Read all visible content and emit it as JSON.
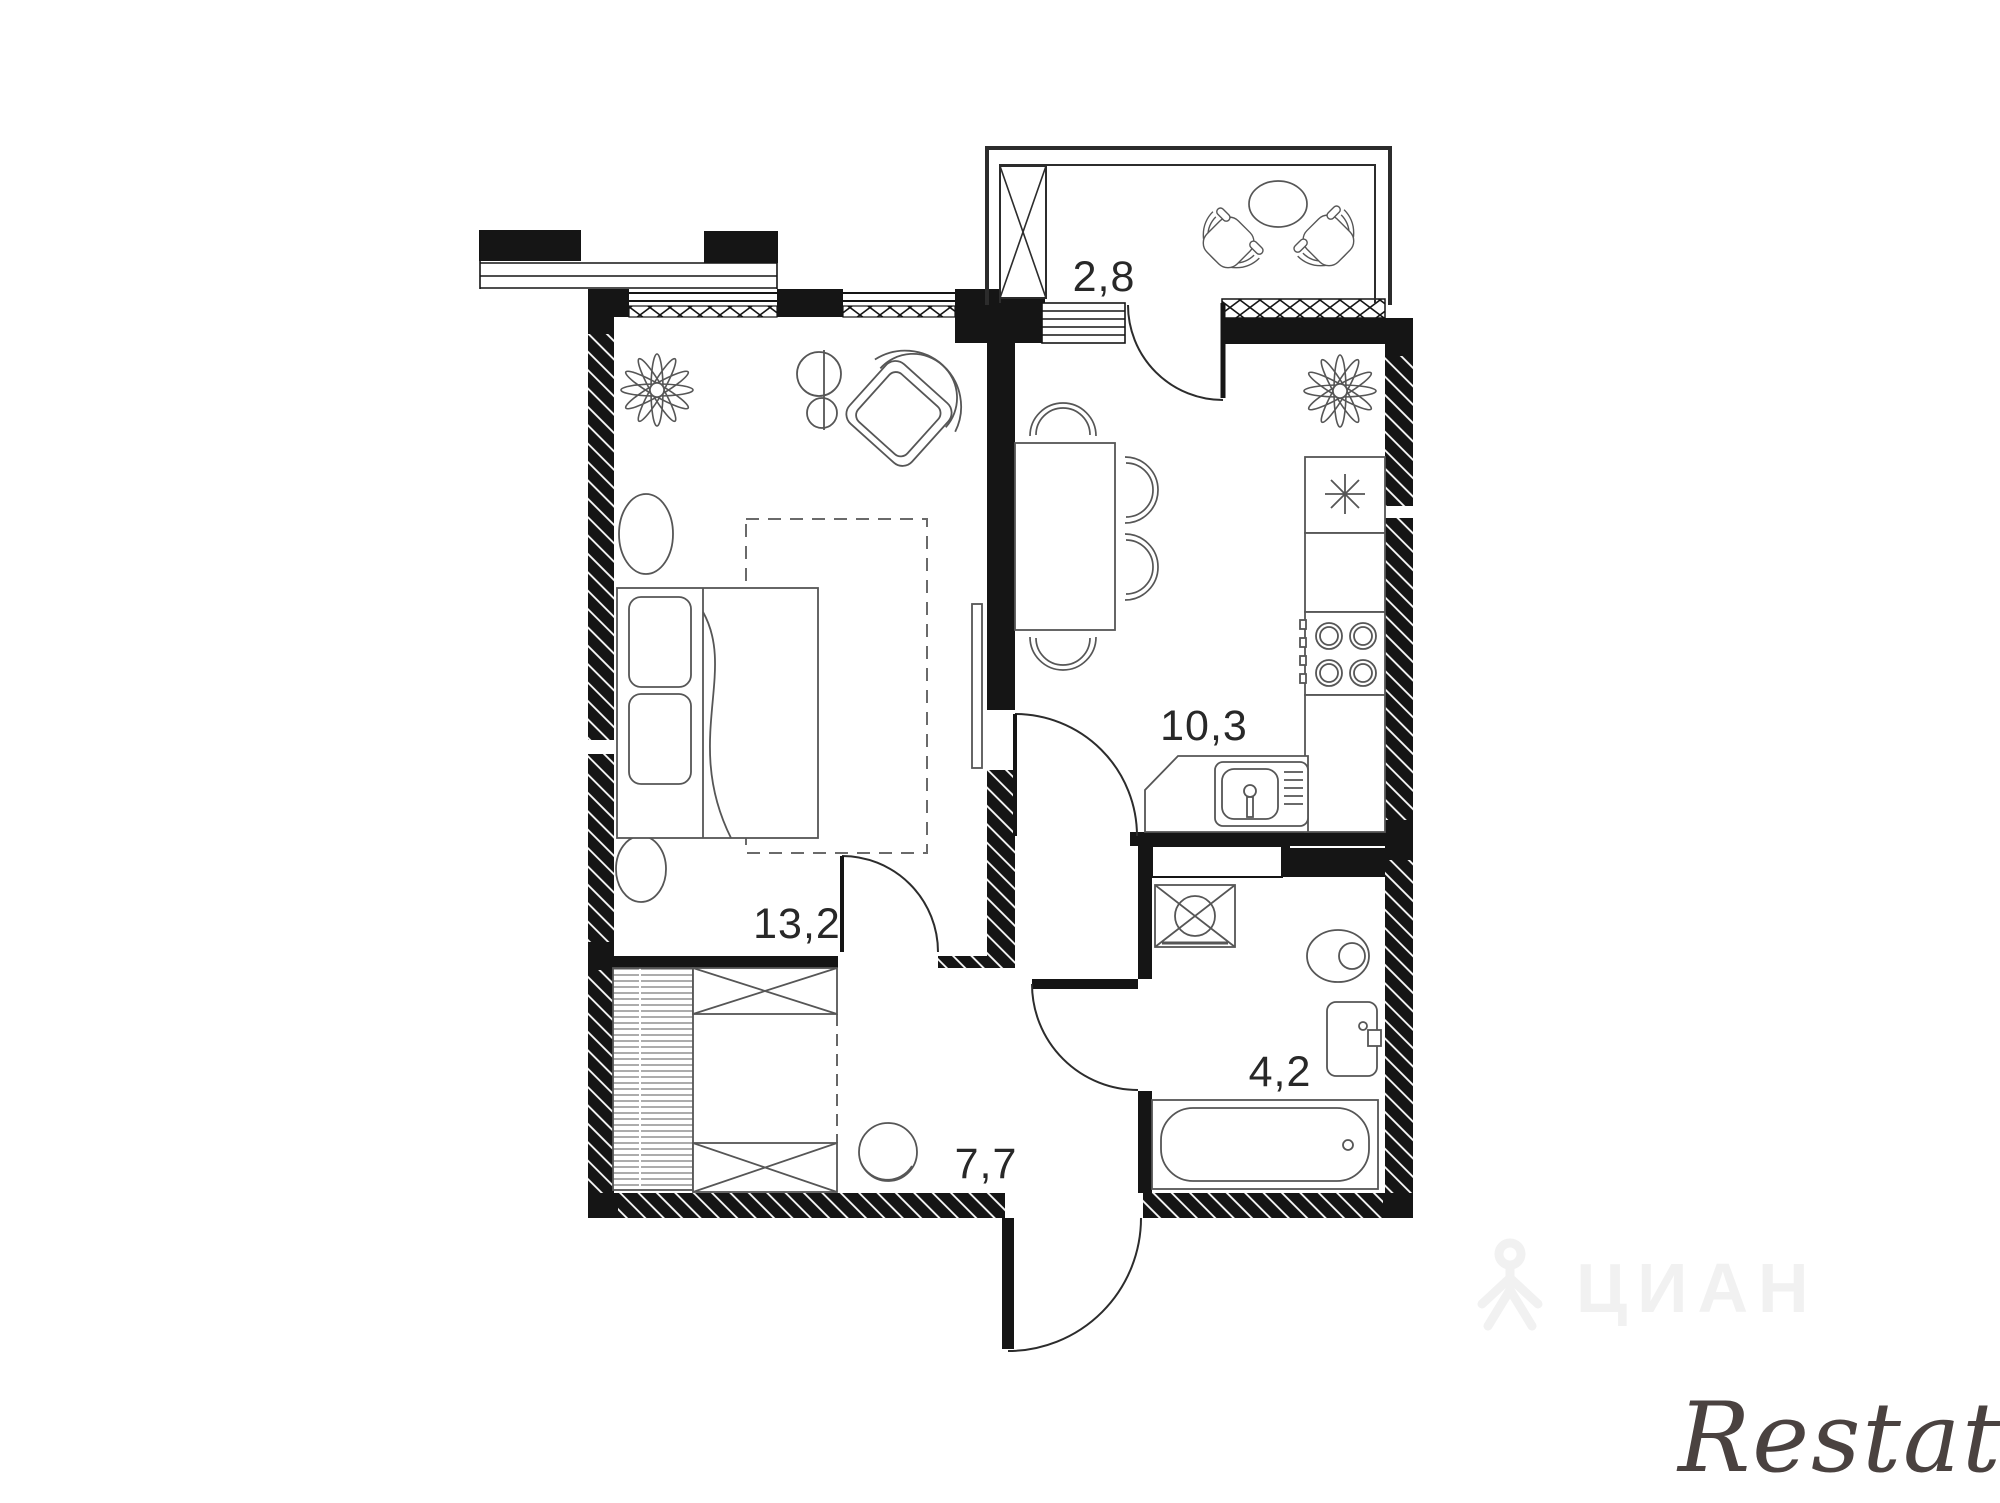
{
  "floorplan": {
    "rooms": [
      {
        "id": "balcony",
        "area": "2,8"
      },
      {
        "id": "kitchen",
        "area": "10,3"
      },
      {
        "id": "bedroom",
        "area": "13,2"
      },
      {
        "id": "hallway",
        "area": "7,7"
      },
      {
        "id": "bathroom",
        "area": "4,2"
      }
    ],
    "watermarks": {
      "center_logo_text": "ЦИАН",
      "bottom_right_text": "Restate"
    },
    "colors": {
      "wall": "#151515",
      "furniture_line": "#4f4f4f",
      "label": "#282828",
      "watermark_faint": "#f1f1f1",
      "watermark_restate": "#4a4240"
    }
  }
}
